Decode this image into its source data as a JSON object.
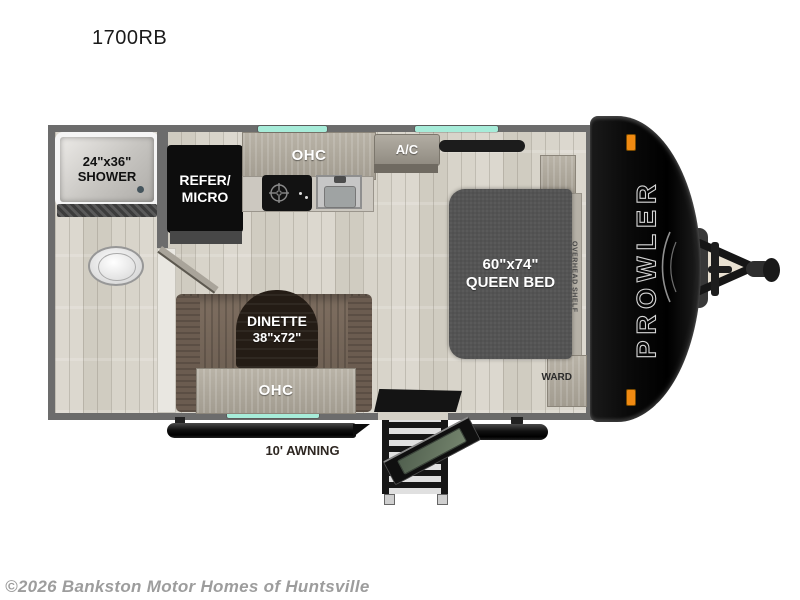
{
  "page": {
    "title": "1700RB",
    "copyright": "©2026 Bankston Motor Homes of Huntsville"
  },
  "colors": {
    "window_accent": "#a7ecd9",
    "marker_light": "#f08a12",
    "front_cap": "#0d0d0d",
    "wall": "#6c6c6c",
    "floor": "#d7d3c9",
    "dinette_upholstery": "#766658"
  },
  "floorplan": {
    "brand": "PROWLER",
    "awning_label": "10' AWNING",
    "bathroom": {
      "shower_line1": "24\"x36\"",
      "shower_line2": "SHOWER",
      "linen": "LINEN",
      "shelves": "SHELVES"
    },
    "kitchen": {
      "refer_line1": "REFER/",
      "refer_line2": "MICRO",
      "ohc": "OHC",
      "ac": "A/C"
    },
    "bedroom": {
      "bed_line1": "60\"x74\"",
      "bed_line2": "QUEEN BED",
      "overhead_shelf": "OVERHEAD SHELF",
      "ward": "WARD"
    },
    "dinette": {
      "line1": "DINETTE",
      "line2": "38\"x72\"",
      "ohc": "OHC"
    }
  }
}
